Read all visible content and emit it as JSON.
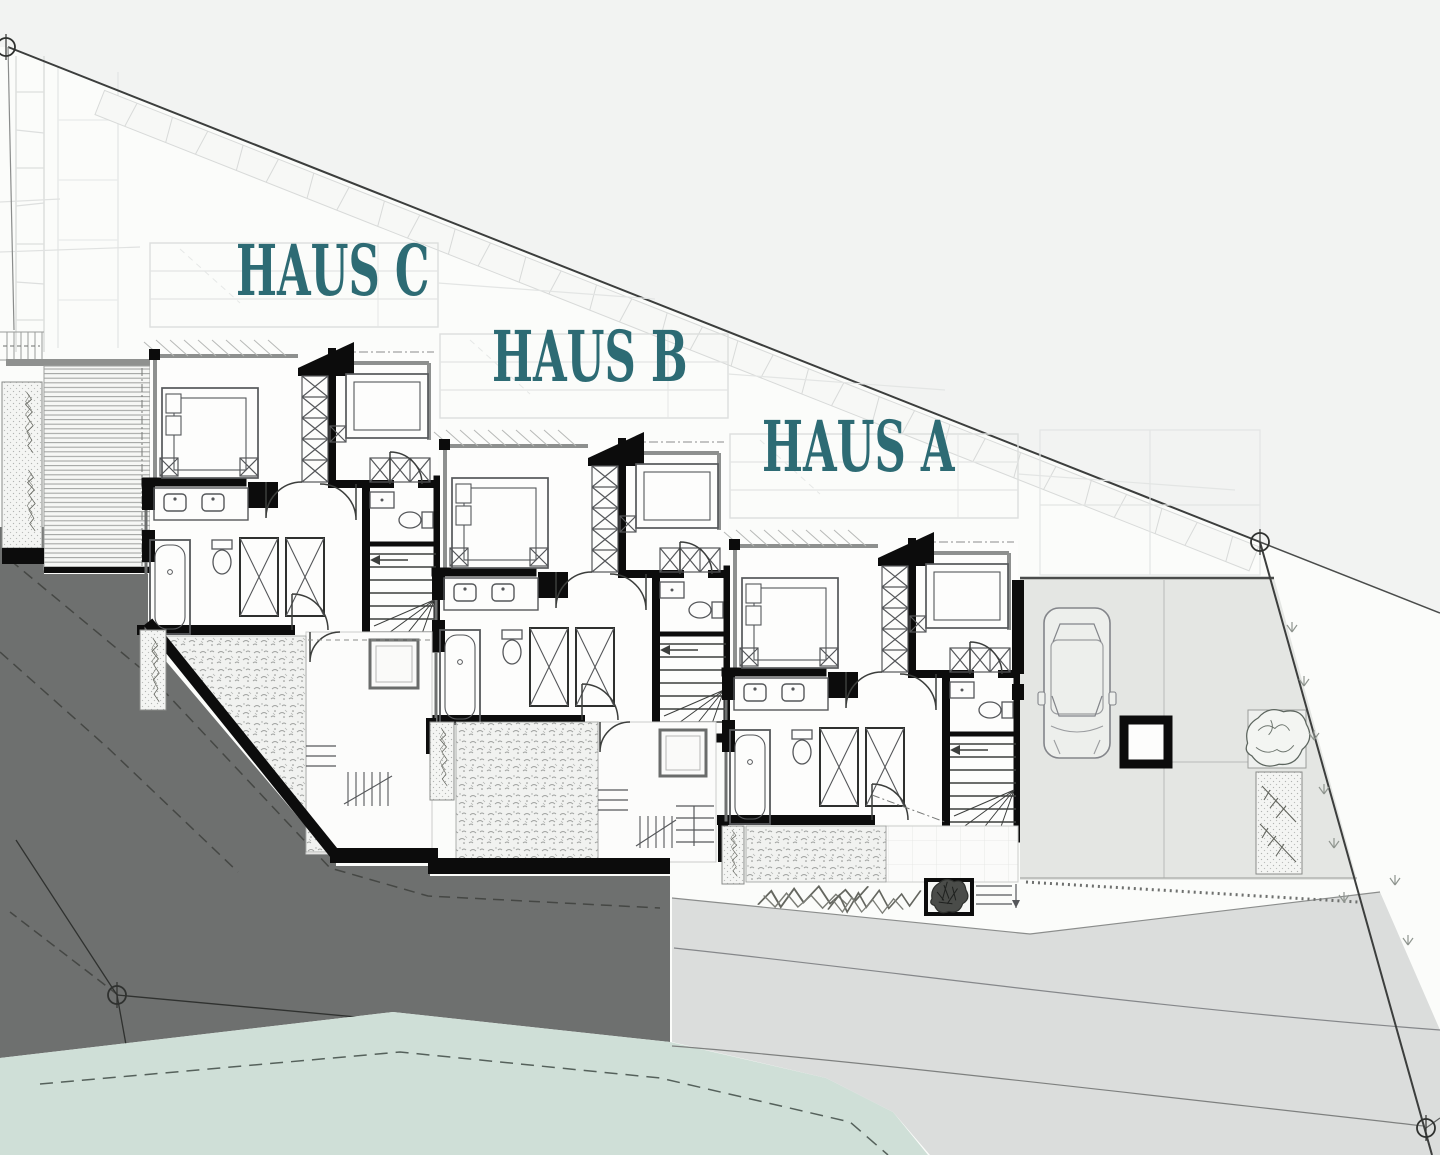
{
  "plan": {
    "houses": [
      {
        "id": "haus-c",
        "label": "HAUS C"
      },
      {
        "id": "haus-b",
        "label": "HAUS B"
      },
      {
        "id": "haus-a",
        "label": "HAUS A"
      }
    ]
  },
  "colors": {
    "label_teal": "#2d6b74",
    "slope_dark_gray": "#6e706f",
    "meadow_green": "#cfdfd7",
    "road_gray": "#dbdddc",
    "driveway_gray": "#e4e6e3",
    "offsite_gray": "#f2f3f2",
    "wall_black": "#0c0c0c",
    "line_gray": "#9a9c9b",
    "patio_white": "#fcfcfb"
  },
  "icons": {
    "car": "car-top-view-icon",
    "tree": "tree-icon",
    "survey_point": "survey-marker-icon",
    "stairs": "stairs-icon",
    "bed": "double-bed-icon",
    "bathtub": "bathtub-icon",
    "wc": "toilet-icon",
    "washbasin": "washbasin-icon",
    "wardrobe": "wardrobe-icon"
  }
}
